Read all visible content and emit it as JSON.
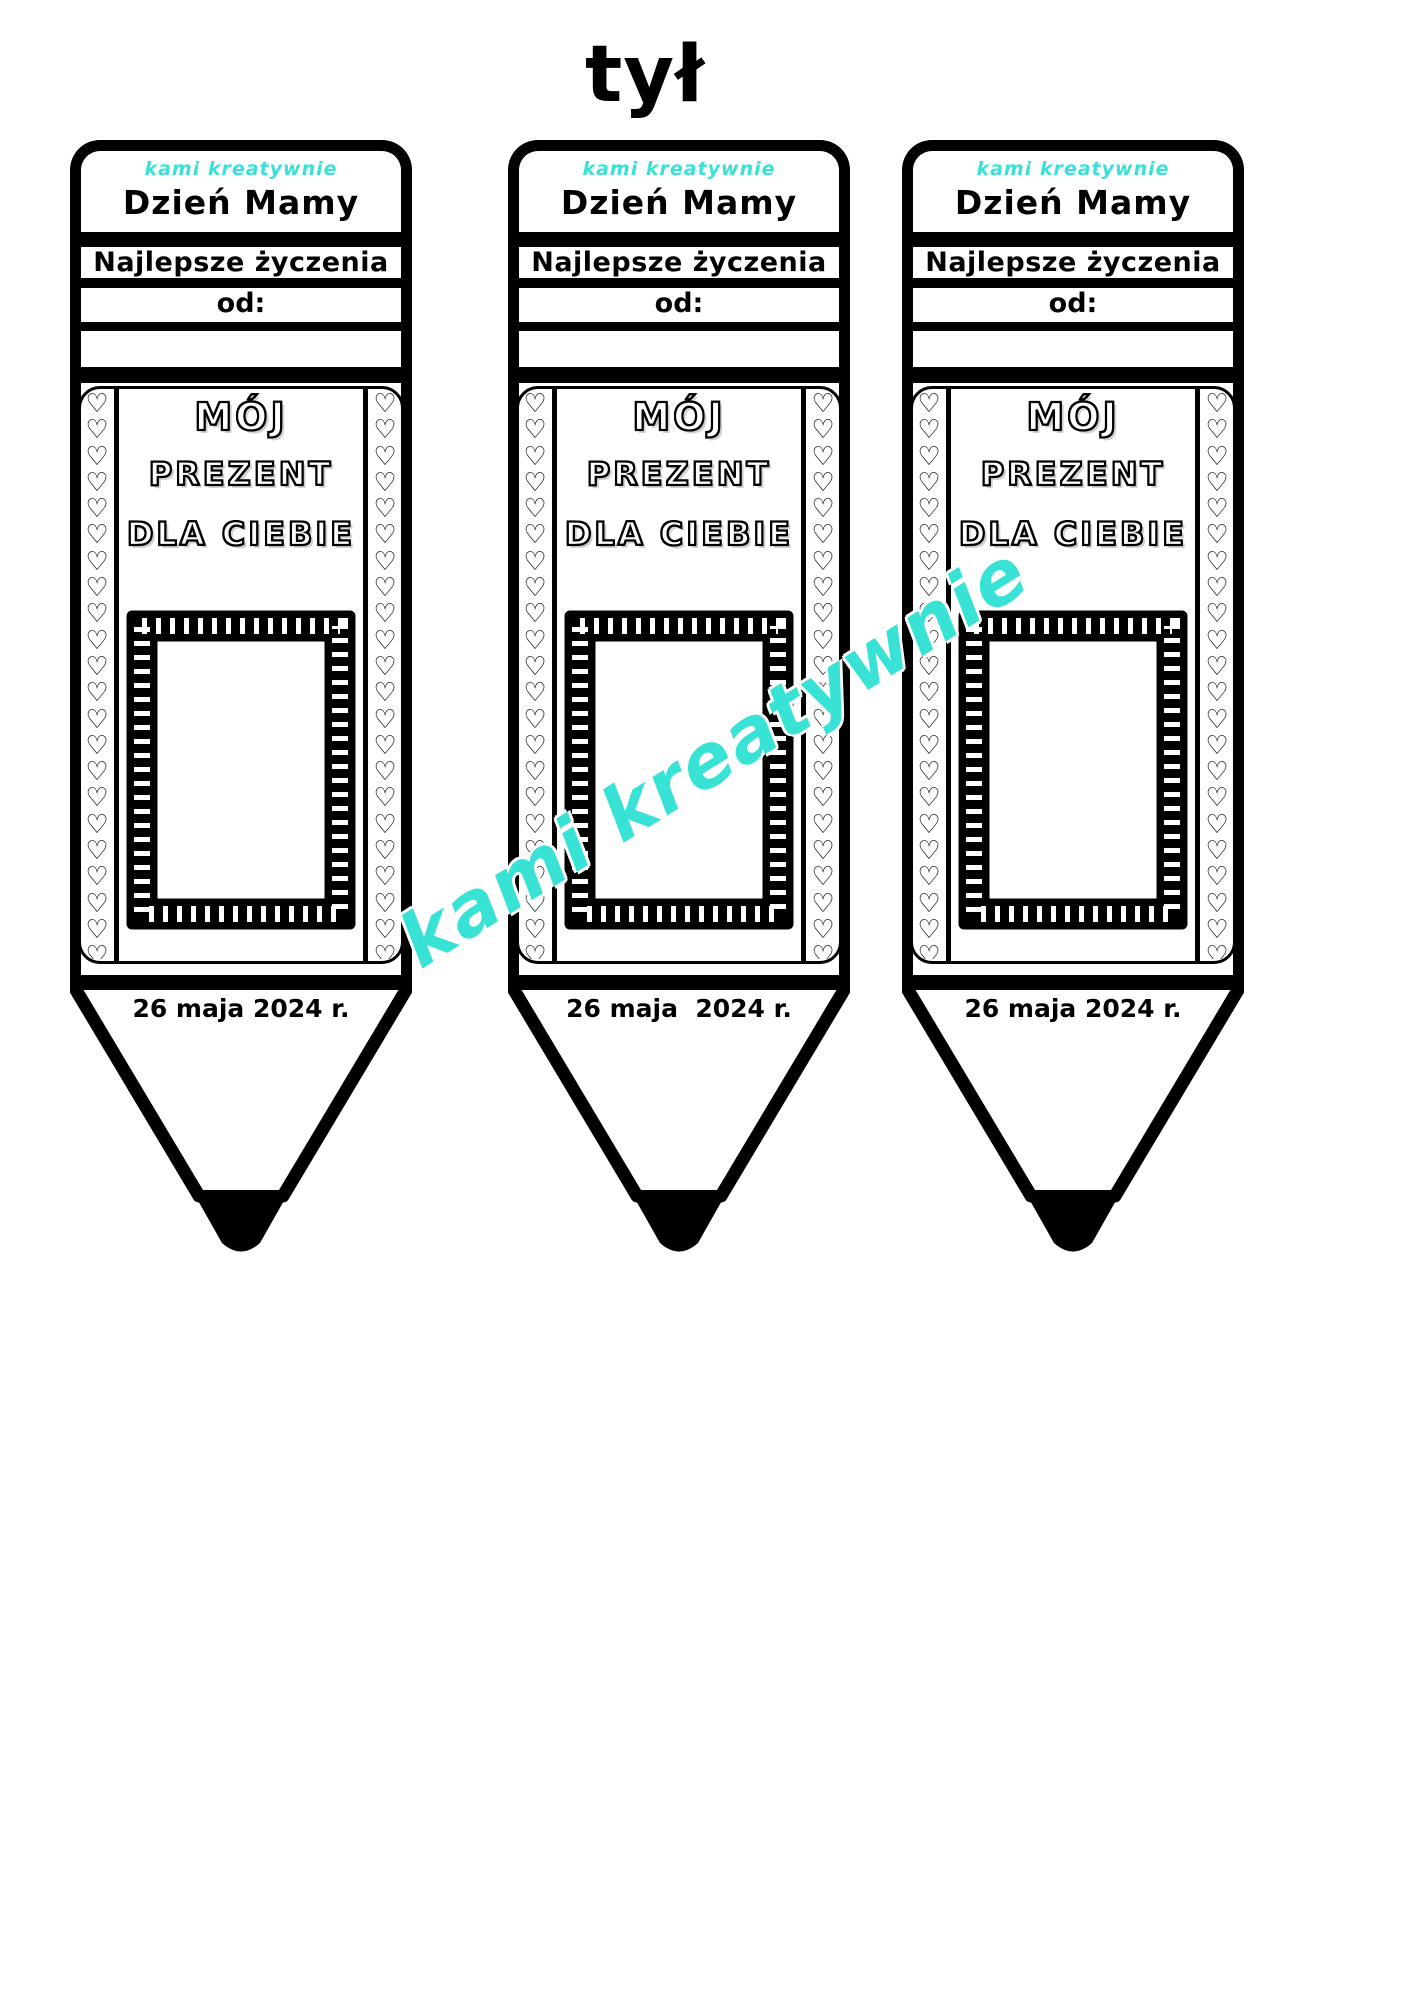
{
  "page": {
    "title": "tył"
  },
  "colors": {
    "ink": "#000000",
    "accent": "#38E2D5",
    "paper": "#ffffff"
  },
  "watermark": {
    "text": "kami kreatywnie"
  },
  "pencils": [
    {
      "brand": "kami kreatywnie",
      "heading": "Dzień Mamy",
      "wishes_label": "Najlepsze życzenia",
      "from_label": "od:",
      "gift_line1": "MÓJ",
      "gift_line2": "PREZENT",
      "gift_line3": "DLA CIEBIE",
      "date": "26 maja 2024 r."
    },
    {
      "brand": "kami kreatywnie",
      "heading": "Dzień Mamy",
      "wishes_label": "Najlepsze życzenia",
      "from_label": "od:",
      "gift_line1": "MÓJ",
      "gift_line2": "PREZENT",
      "gift_line3": "DLA CIEBIE",
      "date": "26 maja  2024 r."
    },
    {
      "brand": "kami kreatywnie",
      "heading": "Dzień Mamy",
      "wishes_label": "Najlepsze życzenia",
      "from_label": "od:",
      "gift_line1": "MÓJ",
      "gift_line2": "PREZENT",
      "gift_line3": "DLA CIEBIE",
      "date": "26 maja 2024 r."
    }
  ]
}
